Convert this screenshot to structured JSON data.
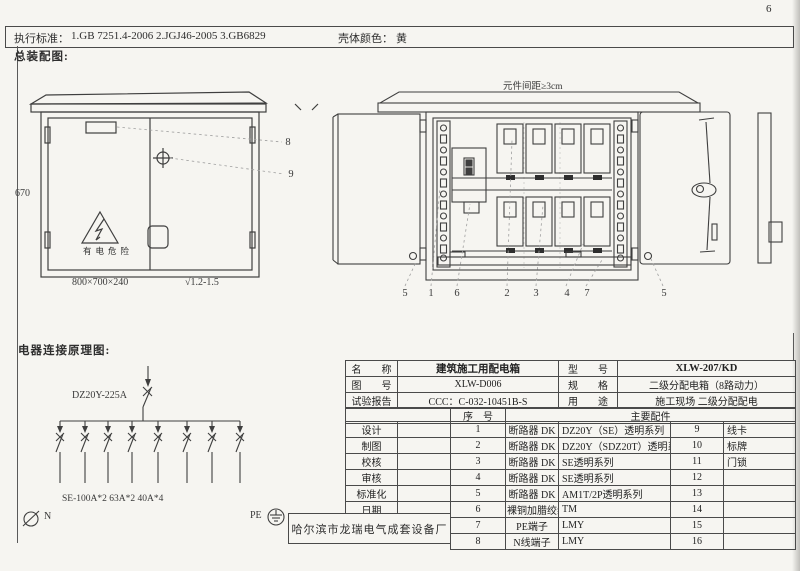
{
  "page": {
    "number": "6"
  },
  "header": {
    "standards_label": "执行标准：",
    "standards": "1.GB 7251.4-2006      2.JGJ46-2005    3.GB6829",
    "shell_color_label": "壳体颜色：",
    "shell_color": "黄"
  },
  "assembly": {
    "section_title": "总装配图:",
    "spacing_note": "元件间距≥3cm",
    "front_view": {
      "height_dim": "670",
      "size_dim": "800×700×240",
      "finish_mark": "√1.2-1.5",
      "warning_text": "有电危险",
      "callout_plate": "8",
      "callout_handle": "9"
    },
    "open_view": {
      "callouts": [
        "5",
        "1",
        "6",
        "2",
        "3",
        "4",
        "7",
        "5"
      ]
    }
  },
  "schematic": {
    "section_title": "电器连接原理图:",
    "main_breaker": "DZ20Y-225A",
    "branch_spec": "SE-100A*2 63A*2 40A*4",
    "neutral_label": "N",
    "pe_label": "PE"
  },
  "spec_table": {
    "info_rows": [
      {
        "label": "名　　称",
        "value": "建筑施工用配电箱",
        "label2": "型　　号",
        "value2": "XLW-207/KD"
      },
      {
        "label": "图　　号",
        "value": "XLW-D006",
        "label2": "规　　格",
        "value2": "二级分配电箱（8路动力）"
      },
      {
        "label": "试验报告",
        "value": "CCC：C-032-10451B-S",
        "label2": "用　　途",
        "value2": "施工现场  二级分配配电"
      }
    ],
    "header": {
      "seq": "序　号",
      "main_parts": "主要配件"
    },
    "sign_labels": [
      "设计",
      "制图",
      "校核",
      "审核",
      "标准化",
      "日期"
    ],
    "parts": [
      {
        "no": "1",
        "name": "断路器 DK",
        "spec": "DZ20Y（SE）透明系列",
        "no2": "9",
        "name2": "线卡"
      },
      {
        "no": "2",
        "name": "断路器 DK",
        "spec": "DZ20Y（SDZ20T）透明系列",
        "no2": "10",
        "name2": "标牌"
      },
      {
        "no": "3",
        "name": "断路器 DK",
        "spec": "SE透明系列",
        "no2": "11",
        "name2": "门锁"
      },
      {
        "no": "4",
        "name": "断路器 DK",
        "spec": "SE透明系列",
        "no2": "12",
        "name2": ""
      },
      {
        "no": "5",
        "name": "断路器 DK",
        "spec": "AM1T/2P透明系列",
        "no2": "13",
        "name2": ""
      },
      {
        "no": "6",
        "name": "裸铜加腊绞线",
        "spec": "TM",
        "no2": "14",
        "name2": ""
      },
      {
        "no": "7",
        "name": "PE端子",
        "spec": "LMY",
        "no2": "15",
        "name2": ""
      },
      {
        "no": "8",
        "name": "N线端子",
        "spec": "LMY",
        "no2": "16",
        "name2": ""
      }
    ],
    "manufacturer": "哈尔滨市龙瑞电气成套设备厂"
  }
}
